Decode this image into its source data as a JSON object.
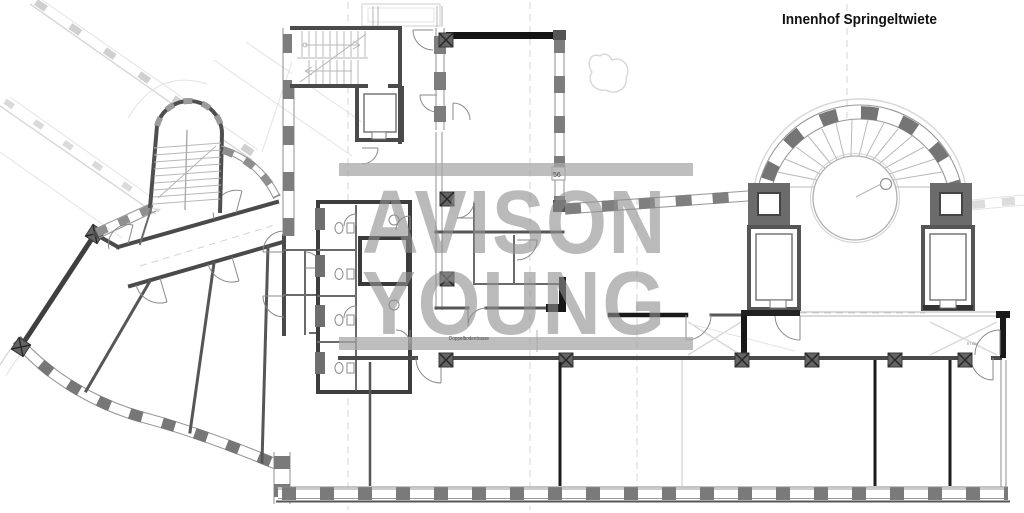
{
  "header": {
    "title": "Innenhof Springeltwiete"
  },
  "watermark": {
    "line1": "AVISON",
    "line2": "YOUNG",
    "color": "#9c9c9c"
  },
  "annotations": {
    "corridor_label": "Doppelbodentrasse",
    "wall_dimension": "56",
    "door_note": "In der"
  },
  "colors": {
    "wall": "#4a4a4a",
    "black_wall": "#191919",
    "pier": "#7a7a7a",
    "faint_outline": "#d8d8d8",
    "watermark_gray": "#9c9c9c",
    "title_text": "#111111",
    "background": "#ffffff"
  },
  "drawing": {
    "type": "architectural-floor-plan",
    "features": [
      "left angled wing with curved facade",
      "central stair and elevator core",
      "sanitary core",
      "double-floor corridor",
      "semicircular rotunda stair",
      "two elevator shafts",
      "pier-and-window facades"
    ]
  }
}
